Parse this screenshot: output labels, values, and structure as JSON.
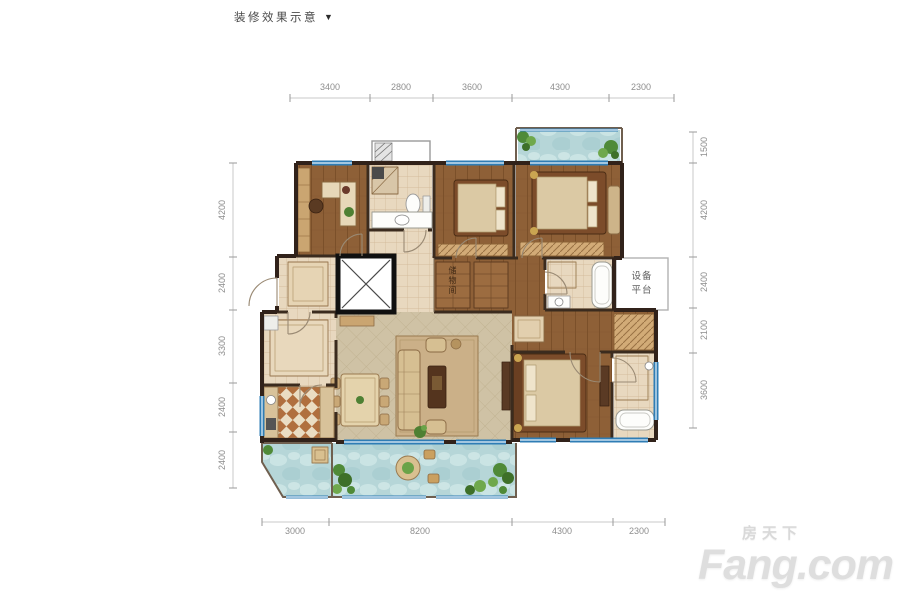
{
  "title": {
    "text": "装修效果示意",
    "arrow": "▼"
  },
  "labels": {
    "equipment_platform": "设备平台",
    "storage": "储物间"
  },
  "dimensions": {
    "top": [
      "3400",
      "2800",
      "3600",
      "4300",
      "2300"
    ],
    "left": [
      "4200",
      "2400",
      "3300",
      "2400",
      "2400"
    ],
    "right": [
      "1500",
      "4200",
      "2400",
      "2100",
      "3600"
    ],
    "bottom": [
      "3000",
      "8200",
      "4300",
      "2300"
    ]
  },
  "watermark": {
    "cn": "房天下",
    "en": "Fang.com"
  },
  "colors": {
    "wall": "#31221a",
    "wood_floor": "#8e6037",
    "tile_floor": "#e8d8bf",
    "living_tile": "#cfc2a5",
    "water_balcony": "#b6d6d8",
    "window_blue": "#2f7db5",
    "kitchen_checker": "#b06f3e",
    "dimension_text": "#8e8e8e",
    "watermark_gray": "#dedede"
  }
}
